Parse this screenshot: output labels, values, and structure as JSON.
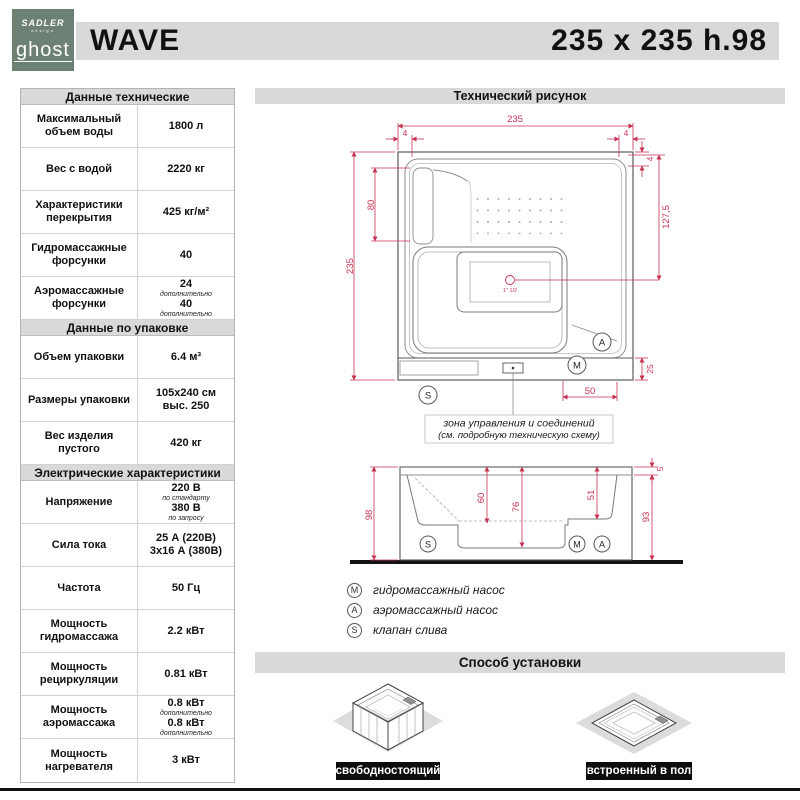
{
  "header": {
    "logo": {
      "line1": "SADLER",
      "line2": "design",
      "name": "ghost"
    },
    "product_name": "WAVE",
    "product_size": "235 x 235 h.98"
  },
  "specs": {
    "sections": [
      {
        "title": "Данные технические",
        "rows": [
          {
            "label": "Максимальный объем воды",
            "value": "1800 л"
          },
          {
            "label": "Вес с водой",
            "value": "2220 кг"
          },
          {
            "label": "Характеристики перекрытия",
            "value": "425 кг/м²"
          },
          {
            "label": "Гидромассажные форсунки",
            "value": "40"
          },
          {
            "label": "Аэромассажные форсунки",
            "value": "24",
            "note": "дополнительно",
            "value2": "40",
            "note2": "дополнительно"
          }
        ]
      },
      {
        "title": "Данные по упаковке",
        "rows": [
          {
            "label": "Объем упаковки",
            "value": "6.4 м³"
          },
          {
            "label": "Размеры упаковки",
            "value": "105x240 см",
            "value2": "выс. 250"
          },
          {
            "label": "Вес изделия пустого",
            "value": "420 кг"
          }
        ]
      },
      {
        "title": "Электрические характеристики",
        "rows": [
          {
            "label": "Напряжение",
            "value": "220 В",
            "note": "по стандарту",
            "value2": "380 В",
            "note2": "по запросу"
          },
          {
            "label": "Сила тока",
            "value": "25 А (220В)",
            "value2": "3x16 А (380В)"
          },
          {
            "label": "Частота",
            "value": "50 Гц"
          },
          {
            "label": "Мощность гидромассажа",
            "value": "2.2 кВт"
          },
          {
            "label": "Мощность рециркуляции",
            "value": "0.81 кВт"
          },
          {
            "label": "Мощность аэромассажа",
            "value": "0.8 кВт",
            "note": "дополнительно",
            "value2": "0.8 кВт",
            "note2": "дополнительно"
          },
          {
            "label": "Мощность нагревателя",
            "value": "3 кВт"
          }
        ]
      }
    ]
  },
  "drawing": {
    "panel_title": "Технический рисунок",
    "top_view": {
      "dim_width": "235",
      "dim_height": "235",
      "dim_corner_left": "4",
      "dim_corner_right": "4",
      "dim_corner_side": "4",
      "dim_seat": "80",
      "dim_right": "127,5",
      "dim_apron": "25",
      "dim_zone": "50",
      "drain_label": "1\" 1/2",
      "marker_a": "A",
      "marker_m": "M",
      "marker_s": "S",
      "zone_note_line1": "зона управления и соединений",
      "zone_note_line2": "(см. подробную техническую схему)"
    },
    "side_view": {
      "dim_total": "98",
      "dim_depth": "60",
      "dim_mid": "76",
      "dim_seat": "51",
      "dim_rim": "5",
      "dim_body": "93",
      "marker_s": "S",
      "marker_m": "M",
      "marker_a": "A"
    },
    "legend": [
      {
        "symbol": "M",
        "label": "гидромассажный насос"
      },
      {
        "symbol": "A",
        "label": "аэромассажный насос"
      },
      {
        "symbol": "S",
        "label": "клапан слива"
      }
    ]
  },
  "installation": {
    "title": "Способ установки",
    "options": [
      {
        "label": "свободностоящий"
      },
      {
        "label": "встроенный в пол"
      }
    ]
  },
  "colors": {
    "accent_red": "#c73352",
    "bar_gray": "#d9d9d9",
    "logo_green": "#6d8074"
  }
}
